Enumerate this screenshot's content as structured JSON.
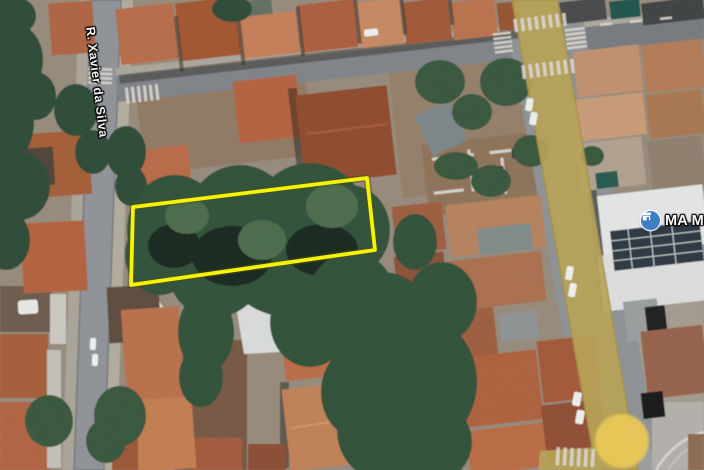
{
  "map": {
    "street_label": "R. Xavier da Silva",
    "place_label": "MA Mat",
    "place_icon": "store-icon",
    "parcel_outline": {
      "points": "133,207 367,178 375,250 131,285",
      "color": "#f8f500"
    },
    "colors": {
      "road_overlay": "#b7a254",
      "intersection_highlight": "#ecc853",
      "place_pin": "#3e80c8",
      "parcel_outline": "#f8f500"
    }
  }
}
